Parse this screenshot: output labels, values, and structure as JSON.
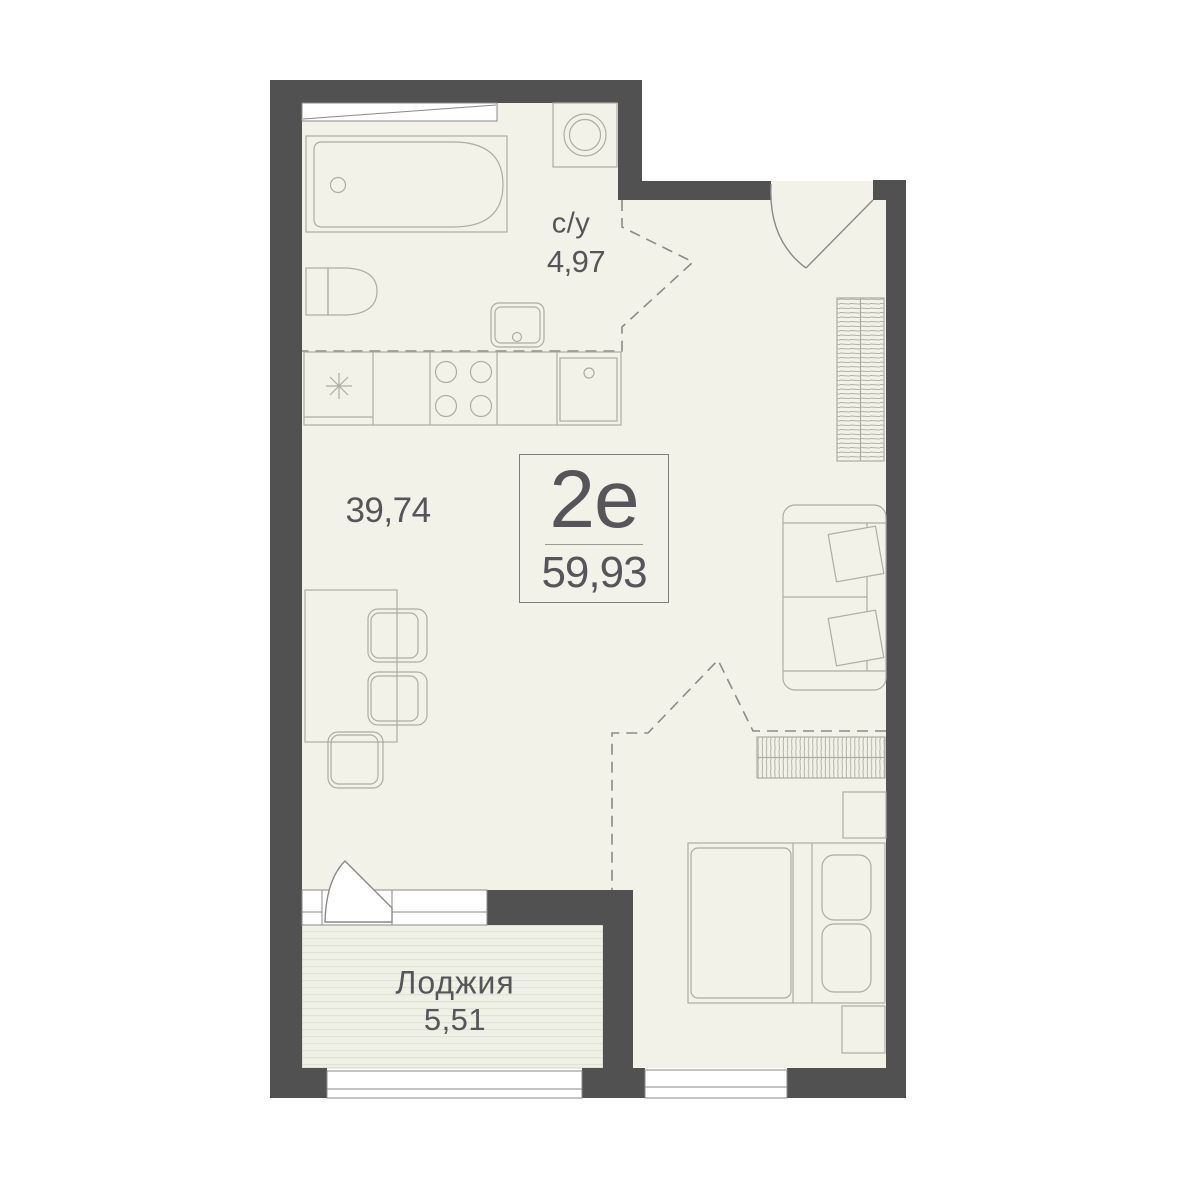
{
  "plan": {
    "unit_label": {
      "type": "2е",
      "total_area": "59,93"
    },
    "rooms": {
      "bathroom": {
        "name": "с/у",
        "area": "4,97"
      },
      "living": {
        "area": "39,74"
      },
      "loggia": {
        "name": "Лоджия",
        "area": "5,51"
      }
    },
    "colors": {
      "wall": "#515151",
      "floor": "#f2f2e9",
      "loggia_stripe": "#e2e3d4",
      "line": "#adada3",
      "frame": "#8a8a86",
      "dashed": "#8c8c86",
      "text": "#55555a"
    }
  }
}
